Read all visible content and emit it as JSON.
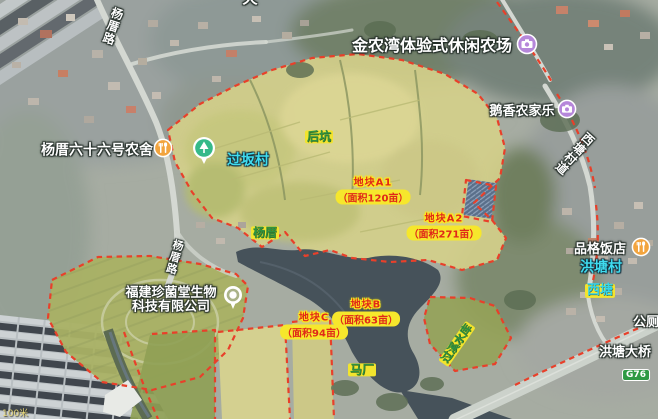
{
  "poi": {
    "jinnongwan": "金农湾体验式休闲农场",
    "exiang": "鹅香农家乐",
    "yangcuo66": "杨厝六十六号农舍",
    "pinge": "品格饭店",
    "company_line1": "福建珍菌堂生物",
    "company_line2": "科技有限公司",
    "toilet": "公厕",
    "bridge": "洪塘大桥"
  },
  "villages": {
    "guoban": "过坂村",
    "hongtang": "洪塘村"
  },
  "places": {
    "houkeng": "后坑",
    "yangcuo": "杨厝",
    "xitang": "西塘",
    "machang": "马厂",
    "reservoir": "过溪水库"
  },
  "roads": {
    "yangcuo_road": "杨厝路",
    "xitang_road": "西塘村道",
    "g76": "G76",
    "top_partial": "天"
  },
  "parcels": [
    {
      "id": "A1",
      "name": "地块A1",
      "area": "（面积120亩）"
    },
    {
      "id": "A2",
      "name": "地块A2",
      "area": "（面积271亩）"
    },
    {
      "id": "B",
      "name": "地块B",
      "area": "（面积63亩）"
    },
    {
      "id": "C",
      "name": "地块C",
      "area": "（面积94亩）"
    }
  ],
  "scale_text": "100米",
  "icons": {
    "camera": "camera-icon",
    "restaurant": "restaurant-icon",
    "park": "park-tree-icon",
    "company_marker": "poi-ring-icon"
  },
  "colors": {
    "boundary_red": "#e8402a",
    "parcel_yellow": "#d4cf8a",
    "label_yellow_bg": "#f2e42e",
    "place_green_text": "#2f9240",
    "village_cyan_text": "#3fdcef",
    "parcel_red_text": "#e02818",
    "water": "#46525a",
    "g76_green": "#2f9a44",
    "camera_purple": "#b687da",
    "restaurant_orange": "#f2a43e",
    "park_teal": "#35b989"
  }
}
